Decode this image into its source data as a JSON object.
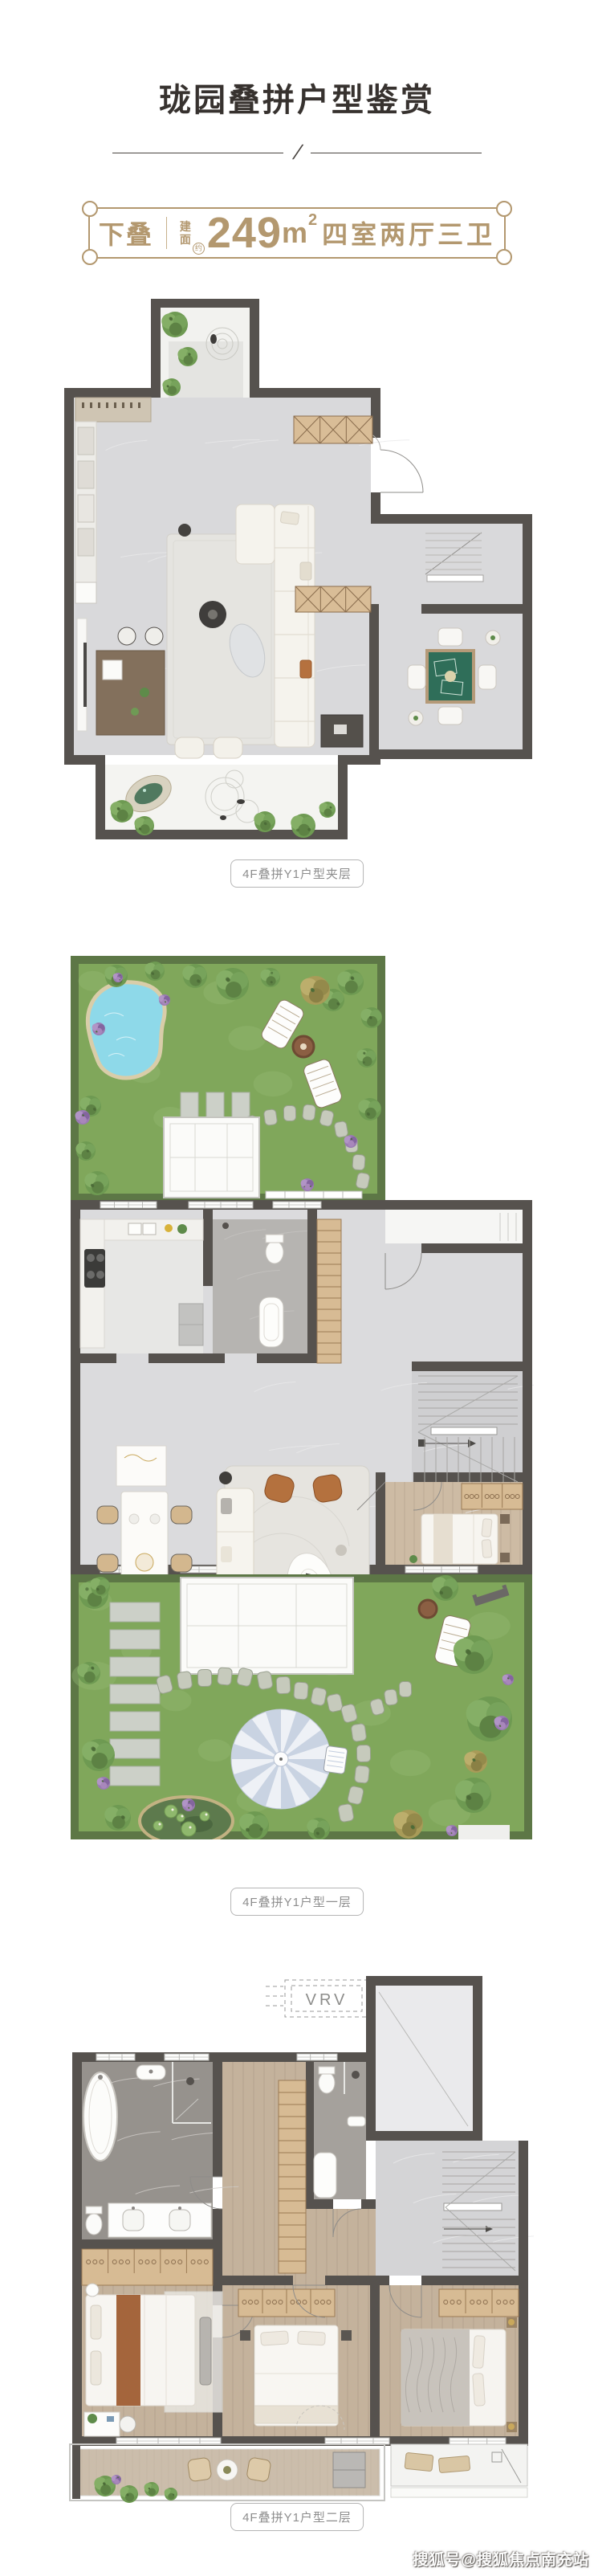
{
  "page": {
    "title": "珑园叠拼户型鉴赏",
    "divider_slash": "/",
    "watermark": "搜狐号@搜狐焦点南充站"
  },
  "badge": {
    "type_label": "下叠",
    "area_label_chars": [
      "建",
      "面"
    ],
    "area_approx": "约",
    "area_value": "249",
    "area_unit": "m",
    "area_unit_exponent": "2",
    "rooms_label": "四室两厅三卫",
    "accent_color": "#b3986f"
  },
  "plans": [
    {
      "id": "mezzanine",
      "caption": "4F叠拼Y1户型夹层"
    },
    {
      "id": "floor-1",
      "caption": "4F叠拼Y1户型一层"
    },
    {
      "id": "floor-2",
      "caption": "4F叠拼Y1户型二层",
      "labels": {
        "vrv": "VRV"
      }
    }
  ],
  "colors": {
    "title_text": "#37322f",
    "caption_text": "#8d8d8d",
    "caption_border": "#b5b5b5",
    "wall": "#56524e",
    "floor_marble_light": "#d9d9db",
    "floor_wood": "#c4b29c",
    "lawn_green": "#80a75b",
    "hedge_green": "#5d7746",
    "pool_blue": "#8ed9e9",
    "mahjong_table_green": "#2f6e59",
    "cabinet_tan": "#d7bb94"
  }
}
